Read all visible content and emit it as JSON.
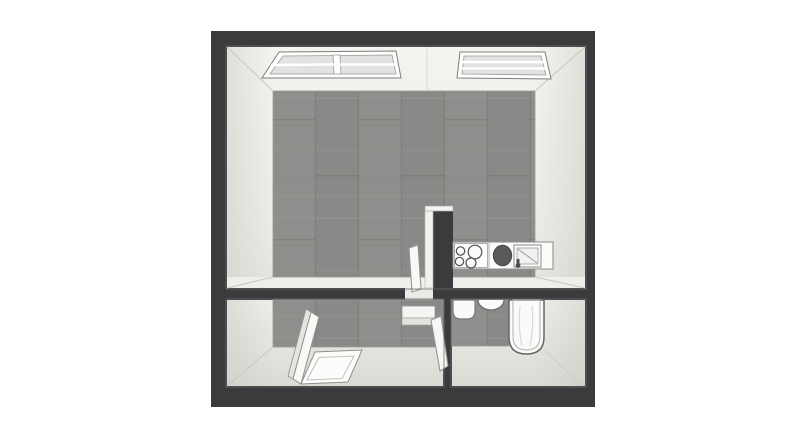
{
  "scene": {
    "title": "3D floor plan render",
    "view": "top-down perspective",
    "background": "#ffffff"
  },
  "colors": {
    "wall_dark": "#3b3b3d",
    "wall_edge_highlight": "#6a6a6d",
    "face_light_top": "#f3f2ef",
    "face_light_bottom": "#e2e1db",
    "face_strip": "#efeeea",
    "floor_base": "#8f8e8c",
    "floor_seam": "#7b7a77",
    "fixture_white": "#f9f8f6",
    "fixture_outline": "#8f8f8f",
    "sink_basin_dark": "#59595b",
    "glass_gray": "#e2e2e0"
  },
  "rooms": {
    "main_room": {
      "label": "main room",
      "flooring": "gray wood planks",
      "features": [
        "skylight window left",
        "skylight window right",
        "kitchen counter",
        "open interior door",
        "partition wall stub"
      ]
    },
    "bottom_left_room": {
      "label": "bottom left room",
      "flooring": "gray wood planks",
      "furniture": [
        "folding panel bed",
        "floor platform",
        "desk",
        "leaning door leaf"
      ]
    },
    "bathroom": {
      "label": "bathroom",
      "flooring": "gray wood planks",
      "fixtures": [
        "wash basin",
        "toilet",
        "bathtub"
      ]
    }
  },
  "windows": {
    "count": 2,
    "location": "top wall",
    "style": "white frame, gray glass, white bars"
  },
  "kitchen": {
    "burner_count": 4,
    "units": [
      "cooktop",
      "round sink basin",
      "drain board",
      "faucet"
    ]
  },
  "walls": {
    "outer": "dark charcoal, thick",
    "divider": "horizontal interior wall with doorway",
    "interior_vertical": "wall between bottom rooms"
  }
}
